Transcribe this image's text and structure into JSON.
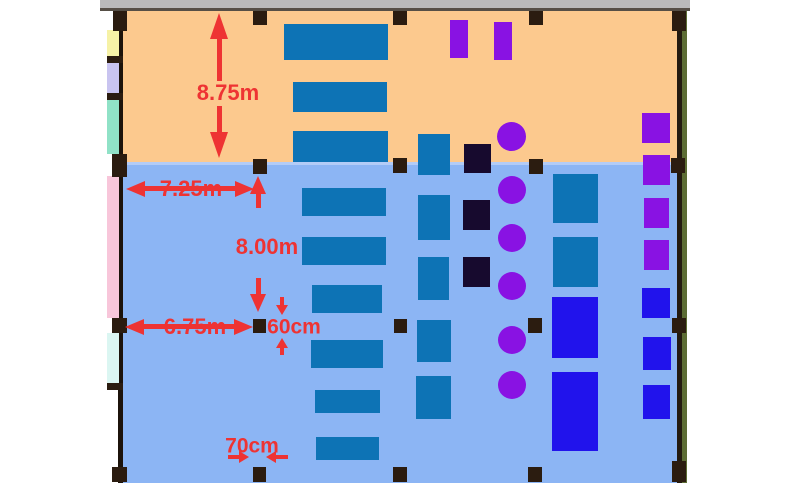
{
  "palette": {
    "annotation_red": "#ee3333",
    "upper_floor": "#fcc98e",
    "lower_floor": "#8cb5f4",
    "desk_blue": "#0d73b5",
    "unit_bright_blue": "#2113ec",
    "unit_purple": "#8912e3",
    "unit_dark_navy": "#170a2e",
    "structure_black": "#2b1c10",
    "top_wall_gray": "#bababa",
    "right_wall_olive": "#5c6c34"
  },
  "dims": {
    "d875": "8.75m",
    "d725": "7.25m",
    "d800": "8.00m",
    "d675": "6.75m",
    "d60": "60cm",
    "d70": "70cm"
  },
  "shapes": [
    {
      "n": "top-wall-bar",
      "t": "rect",
      "x": 100,
      "y": 0,
      "w": 590,
      "h": 8,
      "c": "#bababa"
    },
    {
      "n": "top-wall-edge",
      "t": "rect",
      "x": 100,
      "y": 8,
      "w": 590,
      "h": 3,
      "c": "#564f46"
    },
    {
      "n": "upper-room-floor",
      "t": "rect",
      "x": 118,
      "y": 11,
      "w": 568,
      "h": 152,
      "c": "#fcc98e"
    },
    {
      "n": "lower-room-floor",
      "t": "rect",
      "x": 118,
      "y": 163,
      "w": 568,
      "h": 320,
      "c": "#8cb5f4"
    },
    {
      "n": "room-divider-line",
      "t": "rect",
      "x": 122,
      "y": 162,
      "w": 556,
      "h": 3,
      "c": "#b3ccf7"
    },
    {
      "n": "left-wall",
      "t": "rect",
      "x": 118,
      "y": 11,
      "w": 5,
      "h": 472,
      "c": "#1c130b"
    },
    {
      "n": "right-wall-inner",
      "t": "rect",
      "x": 677,
      "y": 11,
      "w": 5,
      "h": 472,
      "c": "#231a10"
    },
    {
      "n": "right-wall-outer",
      "t": "rect",
      "x": 682,
      "y": 11,
      "w": 5,
      "h": 472,
      "c": "#5c6c34"
    },
    {
      "n": "left-strip-yellow",
      "t": "rect",
      "x": 107,
      "y": 30,
      "w": 12,
      "h": 28,
      "c": "#f6f2a6"
    },
    {
      "n": "left-strip-lavender",
      "t": "rect",
      "x": 107,
      "y": 62,
      "w": 12,
      "h": 33,
      "c": "#c9c4f0"
    },
    {
      "n": "left-strip-mint",
      "t": "rect",
      "x": 107,
      "y": 99,
      "w": 12,
      "h": 55,
      "c": "#90e2c7"
    },
    {
      "n": "left-strip-pink",
      "t": "rect",
      "x": 107,
      "y": 176,
      "w": 12,
      "h": 142,
      "c": "#f8c6da"
    },
    {
      "n": "left-strip-cyan",
      "t": "rect",
      "x": 107,
      "y": 333,
      "w": 12,
      "h": 50,
      "c": "#dbf6f2"
    },
    {
      "n": "left-wall-nub",
      "t": "rect",
      "x": 107,
      "y": 56,
      "w": 16,
      "h": 7,
      "c": "#2b1c10"
    },
    {
      "n": "left-wall-nub",
      "t": "rect",
      "x": 107,
      "y": 93,
      "w": 16,
      "h": 7,
      "c": "#2b1c10"
    },
    {
      "n": "left-wall-nub",
      "t": "rect",
      "x": 107,
      "y": 383,
      "w": 16,
      "h": 7,
      "c": "#2b1c10"
    },
    {
      "n": "column",
      "t": "rect",
      "x": 113,
      "y": 11,
      "w": 14,
      "h": 20,
      "c": "#2b1c10"
    },
    {
      "n": "column",
      "t": "rect",
      "x": 253,
      "y": 11,
      "w": 14,
      "h": 14,
      "c": "#2b1c10"
    },
    {
      "n": "column",
      "t": "rect",
      "x": 393,
      "y": 11,
      "w": 14,
      "h": 14,
      "c": "#2b1c10"
    },
    {
      "n": "column",
      "t": "rect",
      "x": 529,
      "y": 11,
      "w": 14,
      "h": 14,
      "c": "#2b1c10"
    },
    {
      "n": "column",
      "t": "rect",
      "x": 672,
      "y": 11,
      "w": 14,
      "h": 20,
      "c": "#2b1c10"
    },
    {
      "n": "column",
      "t": "rect",
      "x": 112,
      "y": 154,
      "w": 15,
      "h": 23,
      "c": "#2b1c10"
    },
    {
      "n": "column",
      "t": "rect",
      "x": 253,
      "y": 159,
      "w": 14,
      "h": 15,
      "c": "#2b1c10"
    },
    {
      "n": "column",
      "t": "rect",
      "x": 393,
      "y": 158,
      "w": 14,
      "h": 15,
      "c": "#2b1c10"
    },
    {
      "n": "column",
      "t": "rect",
      "x": 529,
      "y": 159,
      "w": 14,
      "h": 15,
      "c": "#2b1c10"
    },
    {
      "n": "column",
      "t": "rect",
      "x": 671,
      "y": 158,
      "w": 14,
      "h": 15,
      "c": "#2b1c10"
    },
    {
      "n": "column",
      "t": "rect",
      "x": 112,
      "y": 318,
      "w": 15,
      "h": 15,
      "c": "#2b1c10"
    },
    {
      "n": "column",
      "t": "rect",
      "x": 253,
      "y": 319,
      "w": 13,
      "h": 14,
      "c": "#2b1c10"
    },
    {
      "n": "column",
      "t": "rect",
      "x": 394,
      "y": 319,
      "w": 13,
      "h": 14,
      "c": "#2b1c10"
    },
    {
      "n": "column",
      "t": "rect",
      "x": 528,
      "y": 318,
      "w": 14,
      "h": 15,
      "c": "#2b1c10"
    },
    {
      "n": "column",
      "t": "rect",
      "x": 672,
      "y": 318,
      "w": 14,
      "h": 15,
      "c": "#2b1c10"
    },
    {
      "n": "column",
      "t": "rect",
      "x": 112,
      "y": 467,
      "w": 15,
      "h": 15,
      "c": "#2b1c10"
    },
    {
      "n": "column",
      "t": "rect",
      "x": 253,
      "y": 467,
      "w": 13,
      "h": 15,
      "c": "#2b1c10"
    },
    {
      "n": "column",
      "t": "rect",
      "x": 393,
      "y": 467,
      "w": 14,
      "h": 15,
      "c": "#2b1c10"
    },
    {
      "n": "column",
      "t": "rect",
      "x": 528,
      "y": 467,
      "w": 14,
      "h": 15,
      "c": "#2b1c10"
    },
    {
      "n": "column",
      "t": "rect",
      "x": 672,
      "y": 461,
      "w": 14,
      "h": 21,
      "c": "#2b1c10"
    },
    {
      "n": "desk",
      "t": "rect",
      "x": 284,
      "y": 24,
      "w": 104,
      "h": 36,
      "c": "#0d73b5"
    },
    {
      "n": "desk",
      "t": "rect",
      "x": 293,
      "y": 82,
      "w": 94,
      "h": 30,
      "c": "#0d73b5"
    },
    {
      "n": "desk",
      "t": "rect",
      "x": 293,
      "y": 131,
      "w": 95,
      "h": 31,
      "c": "#0d73b5"
    },
    {
      "n": "desk",
      "t": "rect",
      "x": 418,
      "y": 134,
      "w": 32,
      "h": 41,
      "c": "#0d73b5"
    },
    {
      "n": "desk",
      "t": "rect",
      "x": 418,
      "y": 195,
      "w": 32,
      "h": 45,
      "c": "#0d73b5"
    },
    {
      "n": "desk",
      "t": "rect",
      "x": 418,
      "y": 257,
      "w": 31,
      "h": 43,
      "c": "#0d73b5"
    },
    {
      "n": "desk",
      "t": "rect",
      "x": 417,
      "y": 320,
      "w": 34,
      "h": 42,
      "c": "#0d73b5"
    },
    {
      "n": "desk",
      "t": "rect",
      "x": 416,
      "y": 376,
      "w": 35,
      "h": 43,
      "c": "#0d73b5"
    },
    {
      "n": "desk",
      "t": "rect",
      "x": 302,
      "y": 188,
      "w": 84,
      "h": 28,
      "c": "#0d73b5"
    },
    {
      "n": "desk",
      "t": "rect",
      "x": 302,
      "y": 237,
      "w": 84,
      "h": 28,
      "c": "#0d73b5"
    },
    {
      "n": "desk",
      "t": "rect",
      "x": 312,
      "y": 285,
      "w": 70,
      "h": 28,
      "c": "#0d73b5"
    },
    {
      "n": "desk",
      "t": "rect",
      "x": 311,
      "y": 340,
      "w": 72,
      "h": 28,
      "c": "#0d73b5"
    },
    {
      "n": "desk",
      "t": "rect",
      "x": 315,
      "y": 390,
      "w": 65,
      "h": 23,
      "c": "#0d73b5"
    },
    {
      "n": "desk",
      "t": "rect",
      "x": 316,
      "y": 437,
      "w": 63,
      "h": 23,
      "c": "#0d73b5"
    },
    {
      "n": "desk",
      "t": "rect",
      "x": 553,
      "y": 174,
      "w": 45,
      "h": 49,
      "c": "#0d73b5"
    },
    {
      "n": "desk",
      "t": "rect",
      "x": 553,
      "y": 237,
      "w": 45,
      "h": 50,
      "c": "#0d73b5"
    },
    {
      "n": "blue-unit",
      "t": "rect",
      "x": 552,
      "y": 297,
      "w": 46,
      "h": 61,
      "c": "#2113ec"
    },
    {
      "n": "blue-unit",
      "t": "rect",
      "x": 552,
      "y": 372,
      "w": 46,
      "h": 79,
      "c": "#2113ec"
    },
    {
      "n": "blue-unit",
      "t": "rect",
      "x": 642,
      "y": 288,
      "w": 28,
      "h": 30,
      "c": "#2113ec"
    },
    {
      "n": "blue-unit",
      "t": "rect",
      "x": 643,
      "y": 337,
      "w": 28,
      "h": 33,
      "c": "#2113ec"
    },
    {
      "n": "blue-unit",
      "t": "rect",
      "x": 643,
      "y": 385,
      "w": 27,
      "h": 34,
      "c": "#2113ec"
    },
    {
      "n": "purple-unit",
      "t": "rect",
      "x": 450,
      "y": 20,
      "w": 18,
      "h": 38,
      "c": "#8912e3"
    },
    {
      "n": "purple-unit",
      "t": "rect",
      "x": 494,
      "y": 22,
      "w": 18,
      "h": 38,
      "c": "#8912e3"
    },
    {
      "n": "purple-unit",
      "t": "rect",
      "x": 642,
      "y": 113,
      "w": 28,
      "h": 30,
      "c": "#8912e3"
    },
    {
      "n": "purple-unit",
      "t": "rect",
      "x": 643,
      "y": 155,
      "w": 27,
      "h": 30,
      "c": "#8912e3"
    },
    {
      "n": "purple-unit",
      "t": "rect",
      "x": 644,
      "y": 198,
      "w": 25,
      "h": 30,
      "c": "#8912e3"
    },
    {
      "n": "purple-unit",
      "t": "rect",
      "x": 644,
      "y": 240,
      "w": 25,
      "h": 30,
      "c": "#8912e3"
    },
    {
      "n": "dark-unit",
      "t": "rect",
      "x": 464,
      "y": 144,
      "w": 27,
      "h": 29,
      "c": "#170a2e"
    },
    {
      "n": "dark-unit",
      "t": "rect",
      "x": 463,
      "y": 200,
      "w": 27,
      "h": 30,
      "c": "#170a2e"
    },
    {
      "n": "dark-unit",
      "t": "rect",
      "x": 463,
      "y": 257,
      "w": 27,
      "h": 30,
      "c": "#170a2e"
    },
    {
      "n": "purple-seat",
      "t": "circle",
      "x": 497,
      "y": 122,
      "w": 29,
      "h": 29,
      "c": "#8912e3"
    },
    {
      "n": "purple-seat",
      "t": "circle",
      "x": 498,
      "y": 176,
      "w": 28,
      "h": 28,
      "c": "#8912e3"
    },
    {
      "n": "purple-seat",
      "t": "circle",
      "x": 498,
      "y": 224,
      "w": 28,
      "h": 28,
      "c": "#8912e3"
    },
    {
      "n": "purple-seat",
      "t": "circle",
      "x": 498,
      "y": 272,
      "w": 28,
      "h": 28,
      "c": "#8912e3"
    },
    {
      "n": "purple-seat",
      "t": "circle",
      "x": 498,
      "y": 326,
      "w": 28,
      "h": 28,
      "c": "#8912e3"
    },
    {
      "n": "purple-seat",
      "t": "circle",
      "x": 498,
      "y": 371,
      "w": 28,
      "h": 28,
      "c": "#8912e3"
    }
  ]
}
